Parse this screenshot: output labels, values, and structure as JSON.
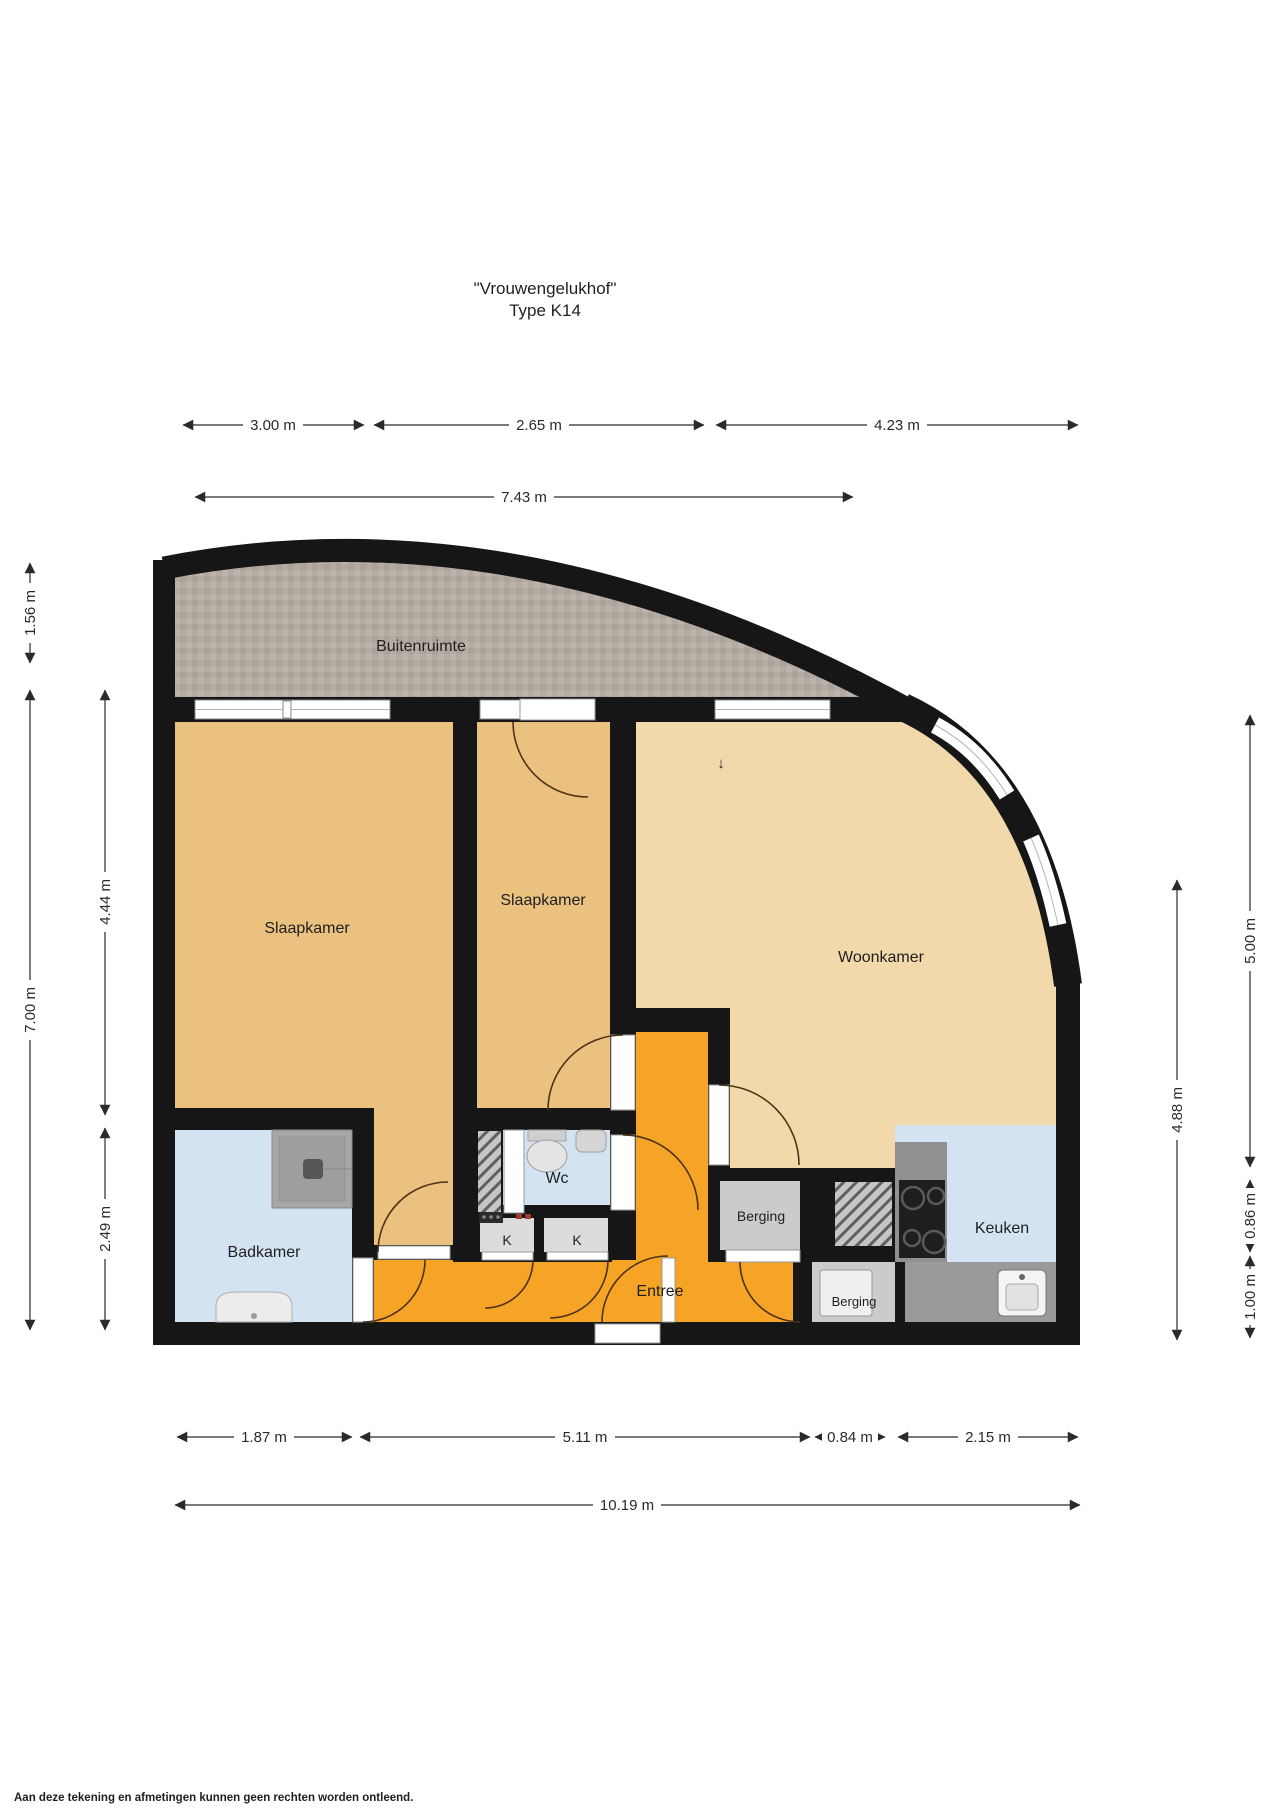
{
  "title": "\"Vrouwengelukhof\"",
  "subtitle": "Type K14",
  "rooms": {
    "buitenruimte": "Buitenruimte",
    "slaapkamer_links": "Slaapkamer",
    "slaapkamer_midden": "Slaapkamer",
    "woonkamer": "Woonkamer",
    "badkamer": "Badkamer",
    "wc": "Wc",
    "entree": "Entree",
    "berging_1": "Berging",
    "berging_2": "Berging",
    "keuken": "Keuken",
    "kast_1": "K",
    "kast_2": "K"
  },
  "dimensions": {
    "top_segments": [
      "3.00 m",
      "2.65 m",
      "4.23 m"
    ],
    "top_total": "7.43 m",
    "left_outer": [
      "1.56 m",
      "7.00 m"
    ],
    "left_inner": [
      "4.44 m",
      "2.49 m"
    ],
    "right_inner": "4.88 m",
    "right_outer": [
      "5.00 m",
      "0.86 m",
      "1.00 m"
    ],
    "bottom_segments": [
      "1.87 m",
      "5.11 m",
      "0.84 m",
      "2.15 m"
    ],
    "bottom_total": "10.19 m"
  },
  "symbols": {
    "entry_arrow": "↓"
  },
  "footer": "Aan deze tekening en afmetingen kunnen geen rechten worden ontleend.",
  "colors": {
    "wall": "#161616",
    "bedroom_floor": "#eac17e",
    "living_floor": "#f2d9ab",
    "hall_floor": "#f6a426",
    "wet_room_floor": "#d4e3f2",
    "storage_floor": "#cbcbcb",
    "balcony_floor": "#b4aba3"
  }
}
